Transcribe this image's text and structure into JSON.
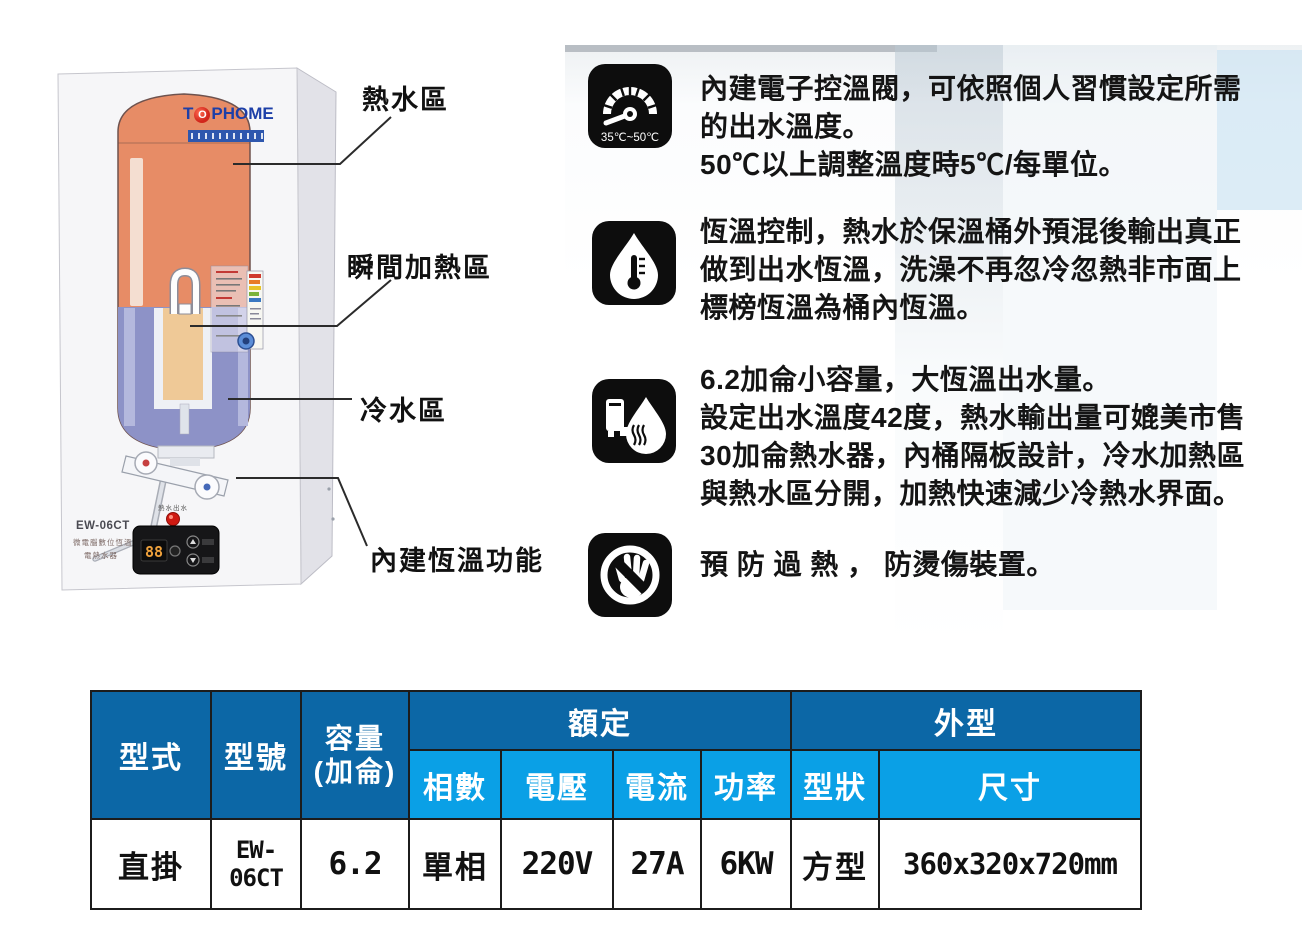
{
  "logo": {
    "t": "T",
    "o": "O",
    "rest": "PHOME"
  },
  "device": {
    "model": "EW-06CT",
    "panel_caption_line1": "微電腦數位恆溫",
    "panel_caption_line2": "電熱水器",
    "indicator_caption": "熱水出水",
    "display_value": "88"
  },
  "callouts": {
    "hot": "熱水區",
    "instant": "瞬間加熱區",
    "cold": "冷水區",
    "thermostat": "內建恆溫功能"
  },
  "features": [
    {
      "icon": "temperature-gauge-icon",
      "icon_caption": "35℃~50℃",
      "lines": [
        "內建電子控溫閥，可依照個人習慣設定所需",
        "的出水溫度。",
        "50℃以上調整溫度時5℃/每單位。"
      ]
    },
    {
      "icon": "droplet-thermometer-icon",
      "lines": [
        "恆溫控制，熱水於保溫桶外預混後輸出真正",
        "做到出水恆溫，洗澡不再忽冷忽熱非市面上",
        "標榜恆溫為桶內恆溫。"
      ]
    },
    {
      "icon": "tank-hot-water-icon",
      "lines": [
        "6.2加侖小容量，大恆溫出水量。",
        "設定出水溫度42度，熱水輸出量可媲美市售",
        "30加侖熱水器，內桶隔板設計，冷水加熱區",
        "與熱水區分開，加熱快速減少冷熱水界面。"
      ]
    },
    {
      "icon": "no-touch-icon",
      "lines": [
        "預 防 過 熱 ， 防燙傷裝置。"
      ]
    }
  ],
  "table": {
    "headers": {
      "type": "型式",
      "model": "型號",
      "capacity_line1": "容量",
      "capacity_line2": "(加侖)",
      "rated": "額定",
      "exterior": "外型"
    },
    "sub_headers": [
      "相數",
      "電壓",
      "電流",
      "功率",
      "型狀",
      "尺寸"
    ],
    "row": [
      "直掛",
      "EW-06CT",
      "6.2",
      "單相",
      "220V",
      "27A",
      "6KW",
      "方型",
      "360x320x720mm"
    ]
  },
  "colors": {
    "header_dark_blue": "#0c67a6",
    "header_light_blue": "#0aa0e6",
    "tank_orange": "#e78c66",
    "cold_zone_blue": "#8d92c7",
    "logo_blue": "#1d3fa8",
    "logo_red": "#d2261b",
    "icon_black": "#0d0d0d"
  }
}
